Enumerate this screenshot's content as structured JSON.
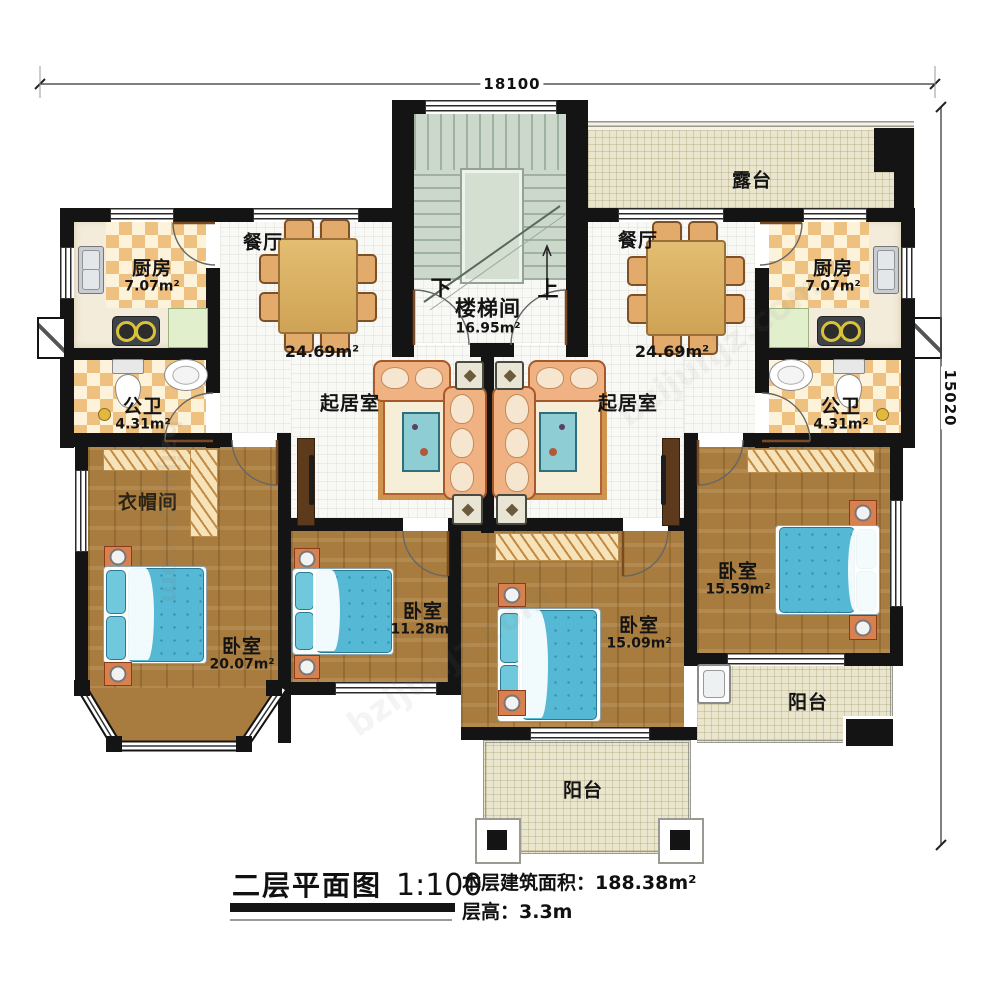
{
  "dimensions": {
    "top": "18100",
    "right": "15020"
  },
  "stairwell": {
    "name": "楼梯间",
    "area": "16.95m²",
    "down": "下",
    "up": "上"
  },
  "rooms": {
    "terrace": {
      "name": "露台"
    },
    "dining_left": {
      "name": "餐厅"
    },
    "dining_right": {
      "name": "餐厅"
    },
    "living_left": {
      "name": "起居室",
      "area": "24.69m²"
    },
    "living_right": {
      "name": "起居室",
      "area": "24.69m²"
    },
    "kitchen_left": {
      "name": "厨房",
      "area": "7.07m²"
    },
    "kitchen_right": {
      "name": "厨房",
      "area": "7.07m²"
    },
    "bath_left": {
      "name": "公卫",
      "area": "4.31m²"
    },
    "bath_right": {
      "name": "公卫",
      "area": "4.31m²"
    },
    "cloakroom": {
      "name": "衣帽间"
    },
    "bedroom_sw": {
      "name": "卧室",
      "area": "20.07m²"
    },
    "bedroom_s": {
      "name": "卧室",
      "area": "11.28m²"
    },
    "bedroom_se": {
      "name": "卧室",
      "area": "15.09m²"
    },
    "bedroom_e": {
      "name": "卧室",
      "area": "15.59m²"
    },
    "balcony_s": {
      "name": "阳台"
    },
    "balcony_e": {
      "name": "阳台"
    }
  },
  "title_block": {
    "plan_title": "二层平面图",
    "scale": "1:100",
    "area_label": "本层建筑面积：",
    "area_value": "188.38m²",
    "floor_height_label": "层高：",
    "floor_height_value": "3.3m"
  },
  "watermark": "bzijunjz.com",
  "colors": {
    "wall": "#141414",
    "wood_floor": "#a87c3e",
    "bed": "#55b8d4",
    "checker": "#eec180",
    "terrace": "#eae5cd",
    "stair": "#ccd8cb",
    "sofa": "#f0b183"
  }
}
